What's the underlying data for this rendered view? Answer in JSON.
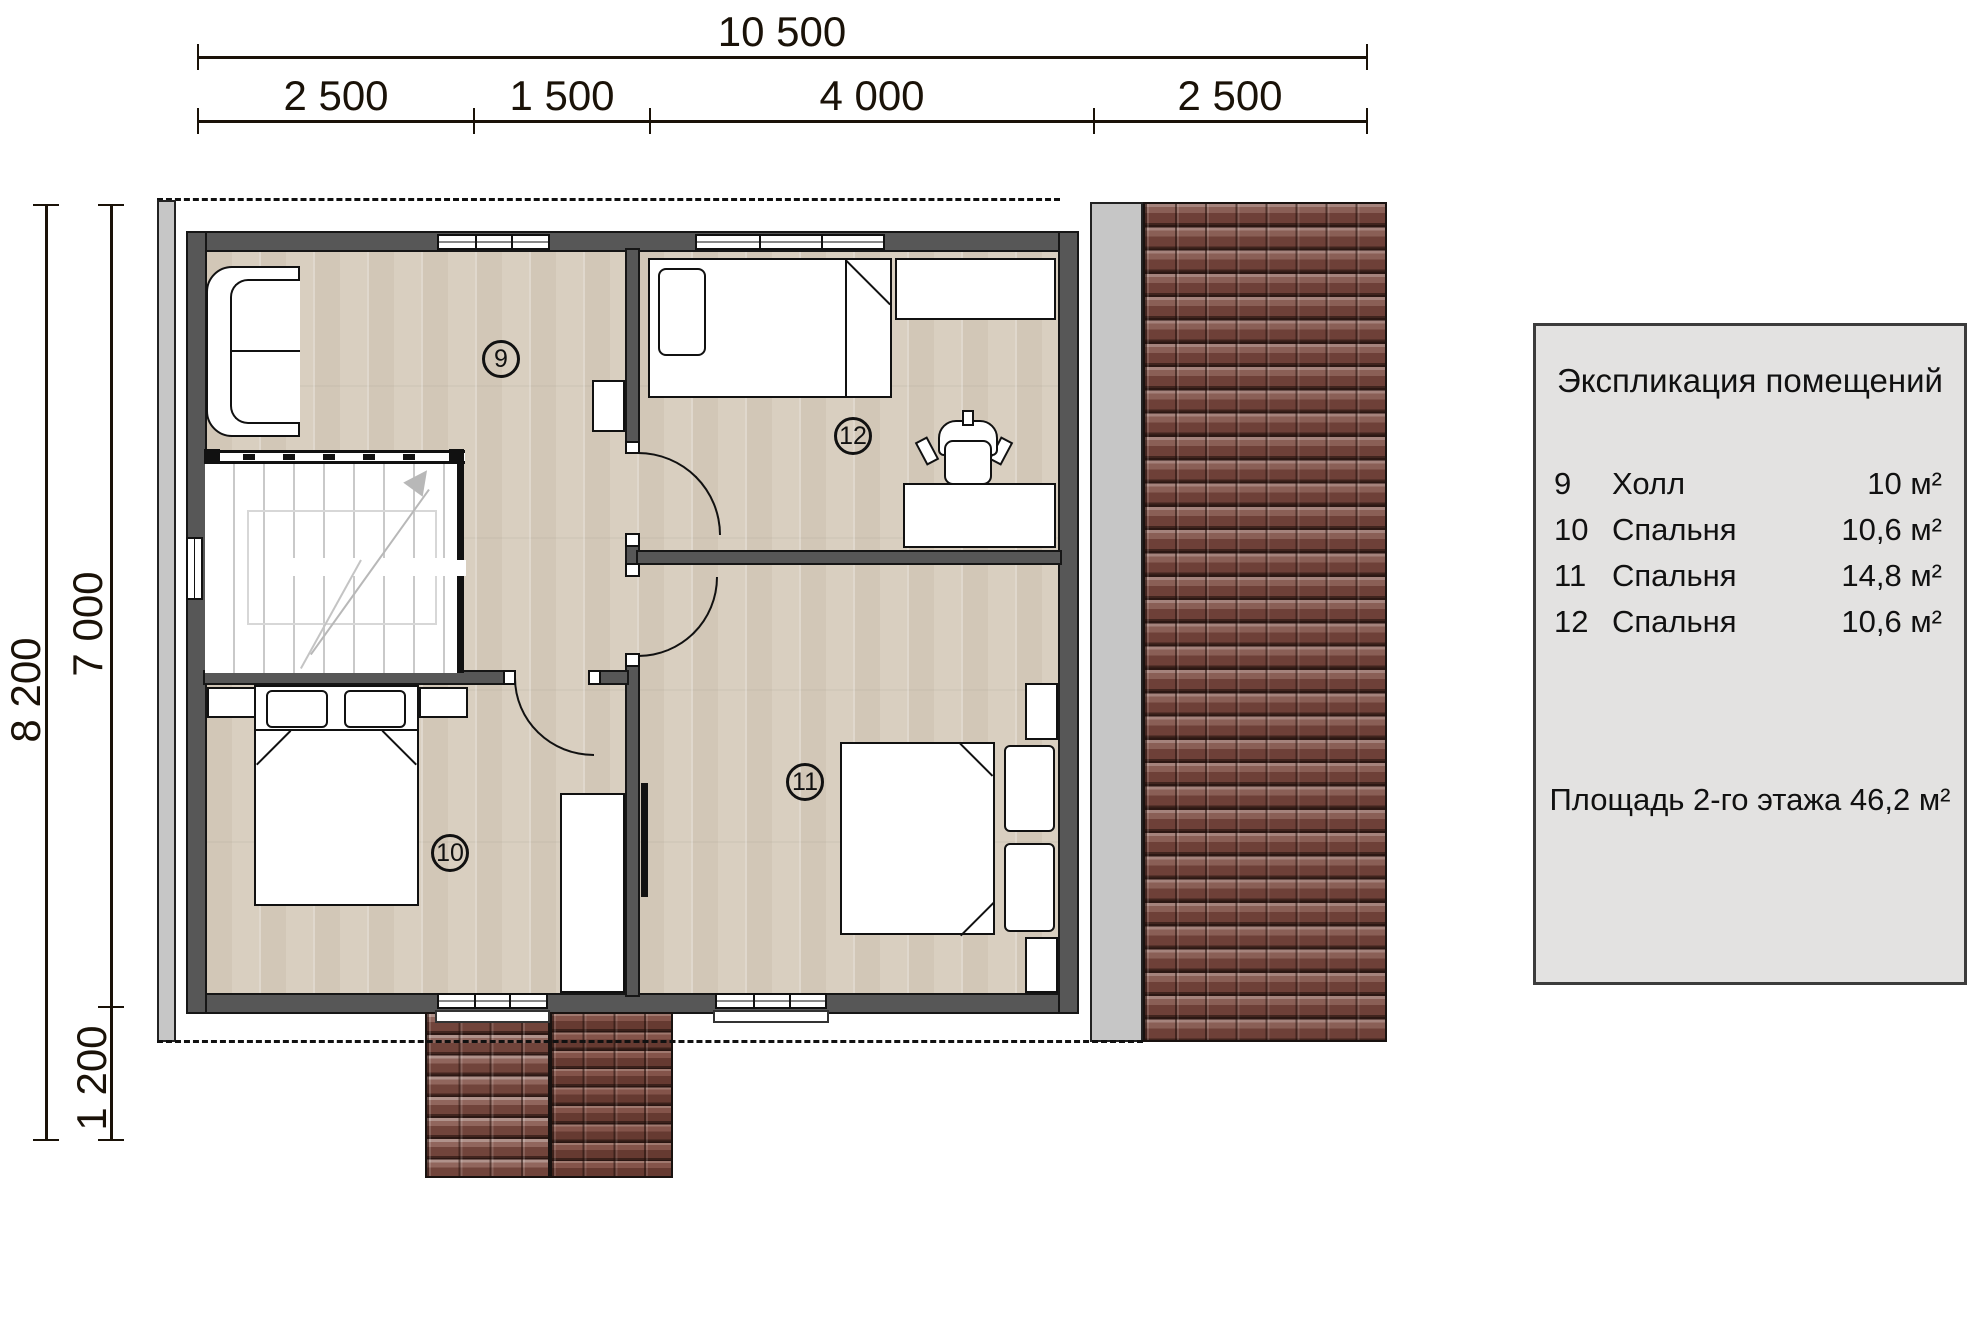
{
  "title": "План 2-го этажа",
  "dimensions": {
    "top_total": "10 500",
    "top_segments": [
      "2 500",
      "1 500",
      "4 000",
      "2 500"
    ],
    "left_total": "8 200",
    "left_inner": [
      "7 000",
      "1 200"
    ]
  },
  "rooms": {
    "r9": "9",
    "r10": "10",
    "r11": "11",
    "r12": "12"
  },
  "legend": {
    "title": "Экспликация помещений",
    "rows": [
      {
        "num": "9",
        "name": "Холл",
        "area": "10 м²"
      },
      {
        "num": "10",
        "name": "Спальня",
        "area": "10,6 м²"
      },
      {
        "num": "11",
        "name": "Спальня",
        "area": "14,8 м²"
      },
      {
        "num": "12",
        "name": "Спальня",
        "area": "10,6 м²"
      }
    ],
    "total": "Площадь 2-го этажа 46,2 м²"
  },
  "colors": {
    "wall": "#575757",
    "floor": "#d9cfc0",
    "roof_edge": "#c6c6c6",
    "tile": "#7a4e45",
    "legend_bg": "#e3e2e1",
    "line": "#111111"
  }
}
